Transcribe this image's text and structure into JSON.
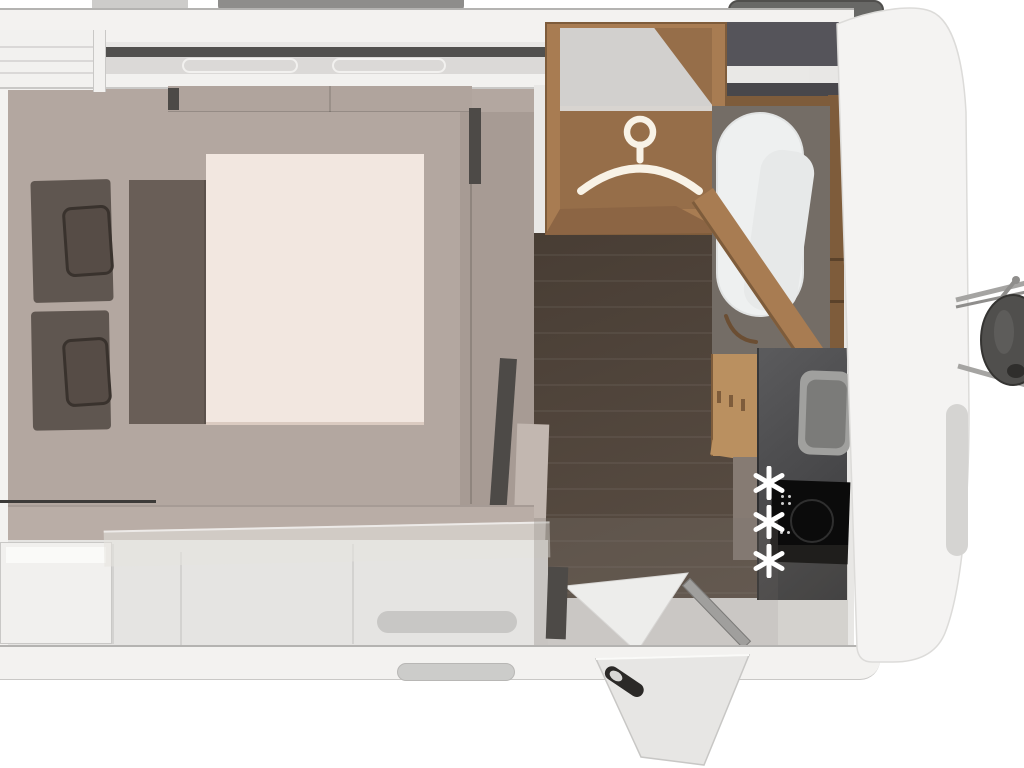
{
  "scene": {
    "name": "caravan-floorplan-top-view",
    "rooms": [
      "bedroom",
      "wardrobe",
      "washroom",
      "kitchen",
      "entrance"
    ],
    "view": "overhead-3d-render",
    "visible_text": []
  },
  "bedroom": {
    "pillow_count": 2,
    "bed": "french-double-bed"
  },
  "wardrobe": {
    "icon": "clothes-hanger-icon"
  },
  "kitchen": {
    "burner_count": 3,
    "burner_icon": "six-spoke-asterisk-icon",
    "appliances": [
      "sink",
      "hob"
    ]
  },
  "entrance": {
    "door_state": "open",
    "handle_icon": "grab-handle-icon"
  },
  "exterior": {
    "parts": [
      "roof-vents",
      "jockey-wheel",
      "drawbar-struts",
      "entry-step"
    ]
  },
  "colors": {
    "bg": "#ffffff",
    "wall_band": "#f3f2f0",
    "wall_line": "#c9c8c6",
    "wall_line2": "#b4b3b1",
    "interior_base": "#e8e7e5",
    "taupe": "#b3a7a0",
    "taupe_dark": "#a1958e",
    "taupe_light": "#c2b7b0",
    "headboard": "#b0a49d",
    "mattress": "#f2e7e0",
    "runner": "#695e57",
    "pillow_base": "#5f5650",
    "pillow": "#564c46",
    "pillow_edge": "#39322d",
    "overhead_strip": "#51504e",
    "cabinet_white": "#f2f1ef",
    "cabinet_band": "#dbd9d7",
    "line_dark": "#3c3a38",
    "floor_dark_1": "#483d34",
    "floor_dark_2": "#5a4e44",
    "partition_dark": "#4d4a47",
    "wood_frame": "#a87c52",
    "wood_dark": "#7e5c3b",
    "wood_dark2": "#8c6544",
    "wood_interior": "#966e49",
    "wood_light": "#ba9060",
    "ward_top_gray": "#d2d0ce",
    "rail_gray": "#d8d4d0",
    "dark_box": "#55545a",
    "dark_box2": "#48474b",
    "shelf_white": "#e9e8e6",
    "bath_base": "#746d66",
    "bath_white": "#eef0f0",
    "bath_white2": "#e7e9e9",
    "worktop_1": "#5b5b5d",
    "worktop_2": "#38383a",
    "sink_outer": "#a0a09e",
    "sink_inner": "#7b7b79",
    "hob_black": "#0b0b0b",
    "hob_ring": "#2f2f2f",
    "taupe_cab": "#867b73",
    "bench_back": "#b9ada6",
    "bench_seat": "#e5e4e2",
    "bench_white": "#f1f0ee",
    "pill_gray": "#c8c7c5",
    "sill_gray": "#a09f9d",
    "overlay_gray": "rgba(125,119,112,0.28)",
    "overlay_gray2": "rgba(120,114,108,0.18)",
    "plane_white": "rgba(230,227,223,0.55)",
    "front_wall": "#f4f3f2",
    "front_wall_edge": "#dcdbd9",
    "front_wall_shade": "#d5d4d2",
    "door_fill": "#e7e6e4",
    "door_edge": "#c8c7c5",
    "handle_dark": "#2b2927",
    "handle_light": "#d8d7d5",
    "vent_dark": "#686866",
    "vent_dark_edge": "#504f4d",
    "vent_mid": "#8e8d8b",
    "vent_light": "#cdccca",
    "wheel": "#504f4d",
    "wheel_edge": "#353432",
    "wheel_hub": "#2f2e2c",
    "strut": "#a5a4a2",
    "strut2": "#8f8e8c",
    "white_triangle": "#ededeb",
    "step_pill": "#ccccca",
    "hanger": "#f8f2e6",
    "asterisk": "#ffffff"
  }
}
